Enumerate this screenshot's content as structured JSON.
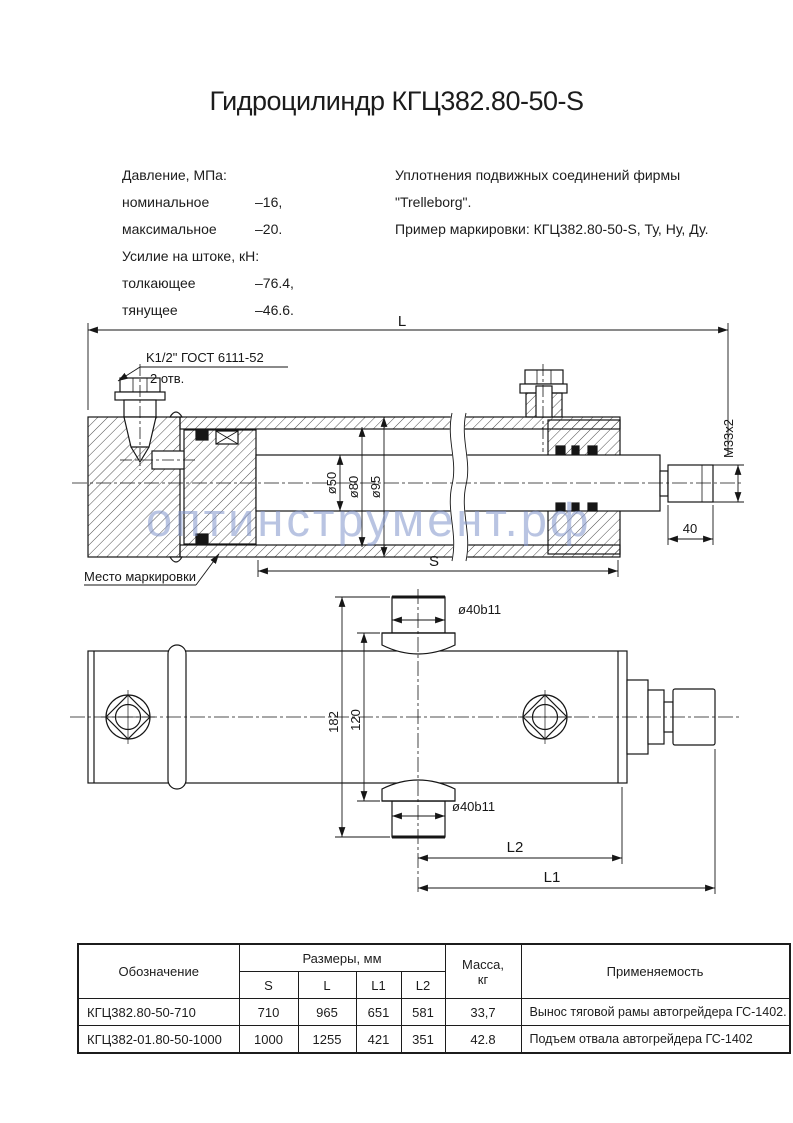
{
  "title": "Гидроцилиндр КГЦ382.80-50-S",
  "specs": {
    "pressure_heading": "Давление, МПа:",
    "pressure_rows": [
      {
        "label": "номинальное",
        "value": "–16,"
      },
      {
        "label": "максимальное",
        "value": "–20."
      }
    ],
    "force_heading": "Усилие на штоке, кН:",
    "force_rows": [
      {
        "label": "толкающее",
        "value": "–76.4,"
      },
      {
        "label": "тянущее",
        "value": "–46.6."
      }
    ],
    "seals_line1": "Уплотнения подвижных соединений фирмы",
    "seals_line2": "\"Trelleborg\".",
    "marking_example": "Пример маркировки: КГЦ382.80-50-S, Ту, Ну, Ду."
  },
  "drawing": {
    "dim_L": "L",
    "port_thread": "K1/2\" ГОСТ 6111-52",
    "port_holes": "2 отв.",
    "dia_rod": "ø50",
    "dia_bore": "ø80",
    "dia_outer": "ø95",
    "rod_thread": "М33х2",
    "dim_40": "40",
    "dim_S": "S",
    "marking_place": "Место маркировки",
    "pin_dia_top": "ø40b11",
    "pin_dia_bottom": "ø40b11",
    "dim_182": "182",
    "dim_120": "120",
    "dim_L2": "L2",
    "dim_L1": "L1"
  },
  "watermark": "оптинструмент.рф",
  "table": {
    "col_designation": "Обозначение",
    "col_sizes": "Размеры, мм",
    "size_cols": [
      "S",
      "L",
      "L1",
      "L2"
    ],
    "col_mass_line1": "Масса,",
    "col_mass_line2": "кг",
    "col_application": "Применяемость",
    "rows": [
      {
        "designation": "КГЦ382.80-50-710",
        "S": "710",
        "L": "965",
        "L1": "651",
        "L2": "581",
        "mass": "33,7",
        "application": "Вынос тяговой рамы автогрейдера ГС-1402."
      },
      {
        "designation": "КГЦ382-01.80-50-1000",
        "S": "1000",
        "L": "1255",
        "L1": "421",
        "L2": "351",
        "mass": "42.8",
        "application": "Подъем отвала автогрейдера ГС-1402"
      }
    ]
  }
}
